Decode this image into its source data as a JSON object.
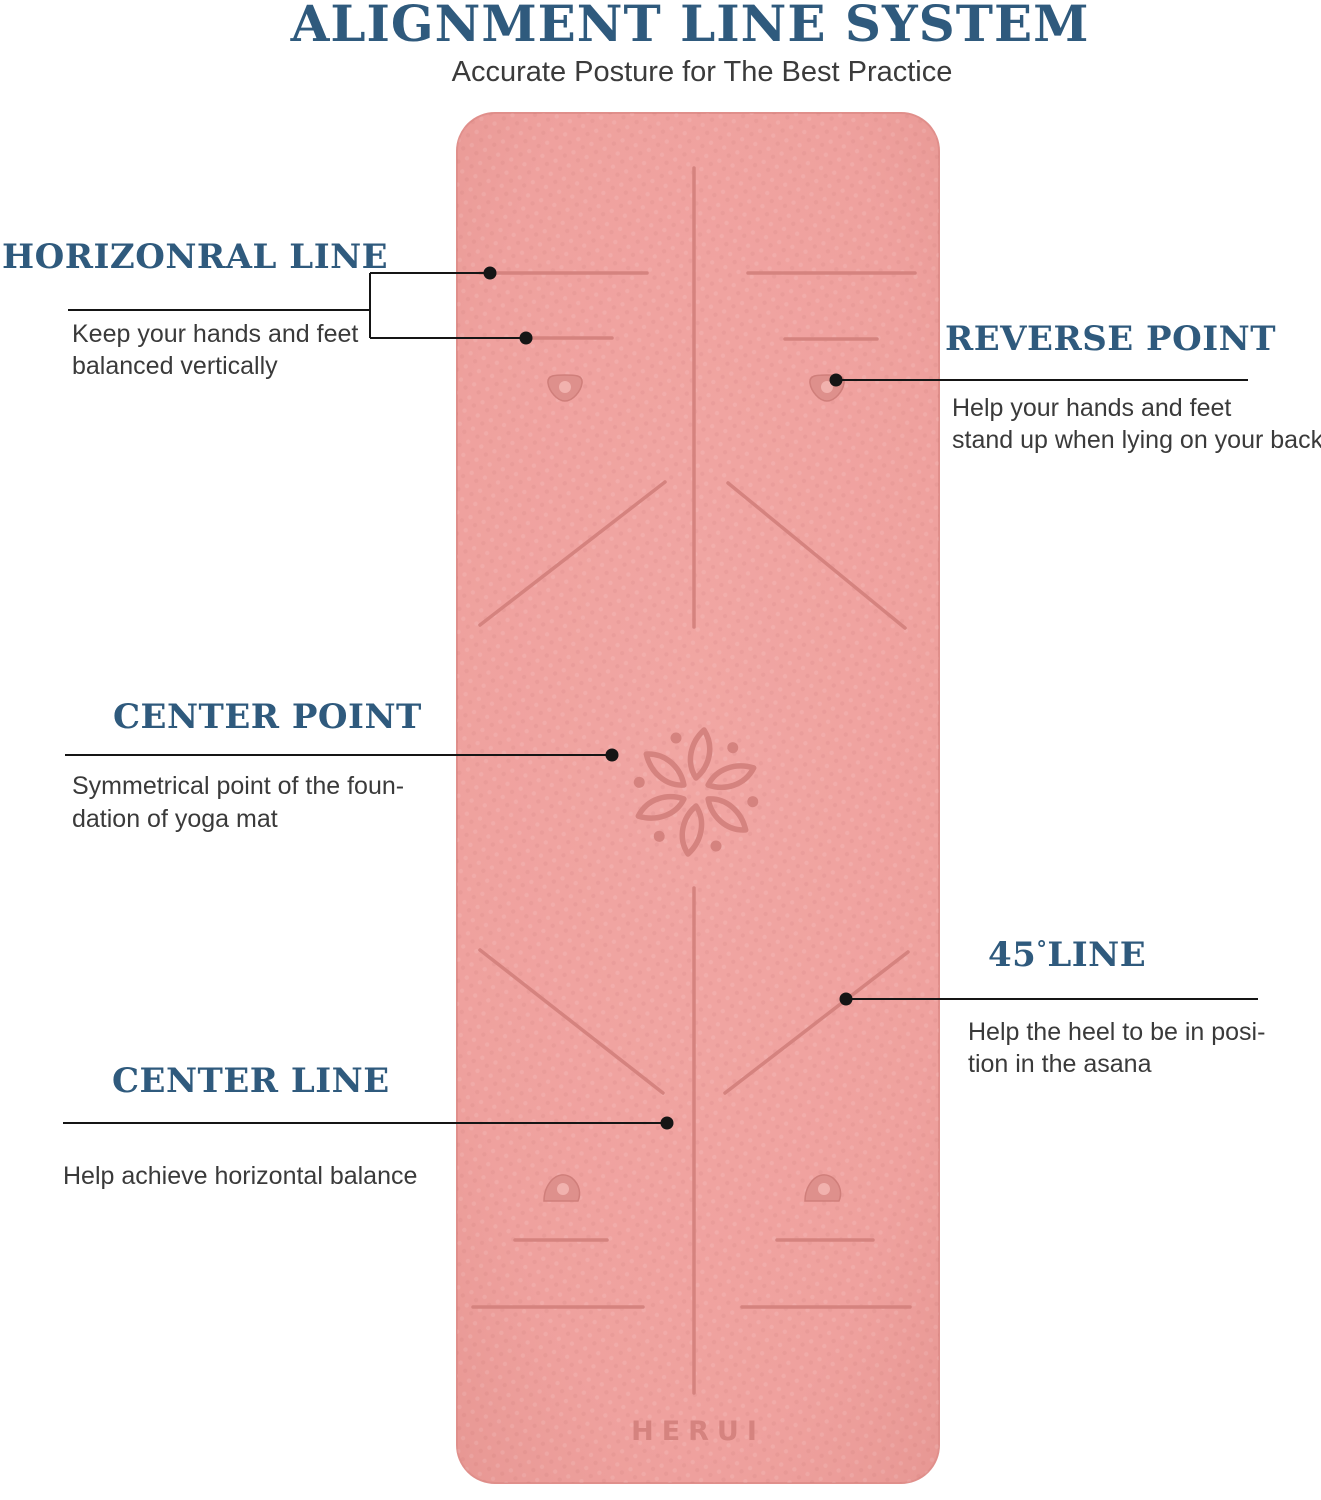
{
  "page": {
    "title": "ALIGNMENT LINE SYSTEM",
    "subtitle": "Accurate Posture for The Best Practice"
  },
  "mat": {
    "brand": "HERUI",
    "color": "#efa19e",
    "marking_color": "#d5837f"
  },
  "accent": {
    "heading_blue": "#2f5a7d",
    "body_text": "#3a3a3a",
    "leader_black": "#151515"
  },
  "labels": {
    "horizontal": {
      "heading": "HORIZONRAL LINE",
      "line1": "Keep your hands and feet",
      "line2": "balanced vertically"
    },
    "reverse": {
      "heading": "REVERSE POINT",
      "line1": "Help your hands and feet",
      "line2": "stand up when lying on your back"
    },
    "center_point": {
      "heading": "CENTER POINT",
      "line1": "Symmetrical point of the foun-",
      "line2": "dation of yoga mat"
    },
    "line45": {
      "num": "45",
      "degree": "°",
      "word": "LINE",
      "line1": "Help the heel to be in posi-",
      "line2": "tion in the asana"
    },
    "center_line": {
      "heading": "CENTER LINE",
      "line1": "Help achieve horizontal balance"
    }
  }
}
